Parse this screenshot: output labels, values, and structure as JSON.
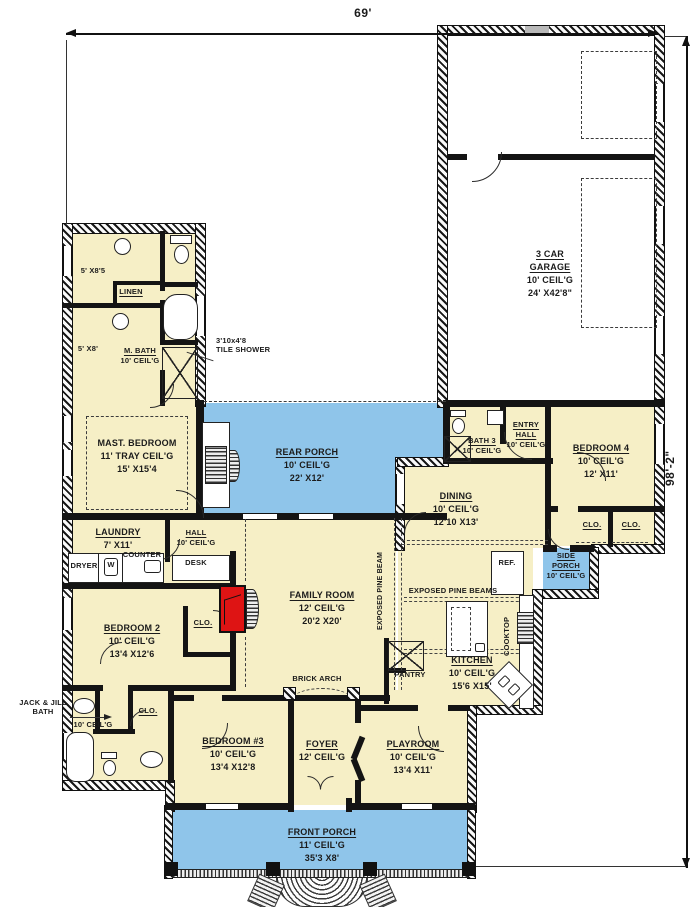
{
  "colors": {
    "floor": "#f6efc6",
    "porch": "#8fc5ea",
    "fire": "#de1414"
  },
  "dims": {
    "w": "69'",
    "h": "98'-2\""
  },
  "rooms": {
    "garage": {
      "n": "3 CAR GARAGE",
      "c": "10' CEIL'G",
      "s": "24' X42'8\""
    },
    "master": {
      "n": "MAST. BEDROOM",
      "c": "11' TRAY CEIL'G",
      "s": "15' X15'4"
    },
    "rear_porch": {
      "n": "REAR PORCH",
      "c": "10' CEIL'G",
      "s": "22' X12'"
    },
    "dining": {
      "n": "DINING",
      "c": "10' CEIL'G",
      "s": "12'10 X13'"
    },
    "bath3": {
      "n": "BATH 3",
      "c": "10' CEIL'G"
    },
    "entry_hall": {
      "n": "ENTRY HALL",
      "c": "10' CEIL'G"
    },
    "bedroom4": {
      "n": "BEDROOM 4",
      "c": "10' CEIL'G",
      "s": "12' X11'"
    },
    "side_porch": {
      "n": "SIDE PORCH",
      "c": "10' CEIL'G"
    },
    "family": {
      "n": "FAMILY ROOM",
      "c": "12' CEIL'G",
      "s": "20'2 X20'"
    },
    "kitchen": {
      "n": "KITCHEN",
      "c": "10' CEIL'G",
      "s": "15'6 X15'"
    },
    "laundry": {
      "n": "LAUNDRY",
      "s": "7' X11'"
    },
    "hall": {
      "n": "HALL",
      "c": "10' CEIL'G"
    },
    "bedroom2": {
      "n": "BEDROOM 2",
      "c": "10' CEIL'G",
      "s": "13'4 X12'6"
    },
    "bedroom3": {
      "n": "BEDROOM #3",
      "c": "10' CEIL'G",
      "s": "13'4 X12'8"
    },
    "foyer": {
      "n": "FOYER",
      "c": "12' CEIL'G"
    },
    "playroom": {
      "n": "PLAYROOM",
      "c": "10' CEIL'G",
      "s": "13'4 X11'"
    },
    "front_porch": {
      "n": "FRONT PORCH",
      "c": "11' CEIL'G",
      "s": "35'3 X8'"
    },
    "mbath": {
      "n": "M. BATH",
      "c": "10' CEIL'G"
    }
  },
  "labels": {
    "clo": "CLO.",
    "linen": "LINEN",
    "closet_a": "5' X8'5",
    "closet_b": "5' X8'",
    "dryer": "DRYER",
    "washer": "W",
    "counter": "COUNTER",
    "desk": "DESK",
    "ref": "REF.",
    "cooktop": "COOKTOP",
    "pantry": "PANTRY",
    "brick_arch": "BRICK ARCH",
    "beams_h": "EXPOSED PINE BEAMS",
    "beam_v": "EXPOSED PINE BEAM",
    "jj_l1": "JACK & JILL",
    "jj_l2": "BATH",
    "jj_ceil": "10' CEIL'G",
    "shower_l1": "3'10x4'8",
    "shower_l2": "TILE SHOWER"
  }
}
